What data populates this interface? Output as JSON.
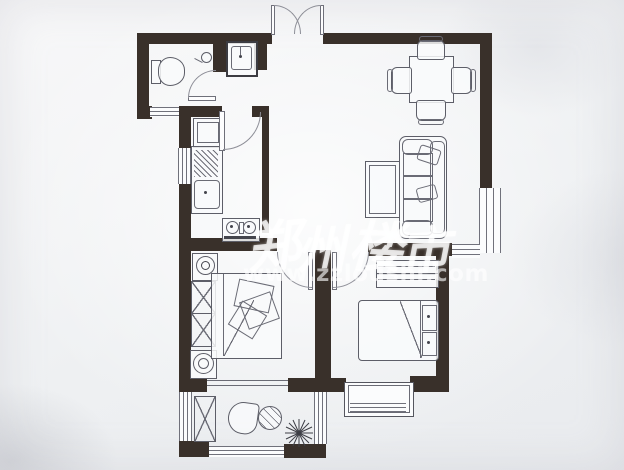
{
  "watermark": {
    "chars": [
      "郑",
      "州",
      "楼",
      "市"
    ],
    "url": "www.zzloushi.com"
  },
  "colors": {
    "wall": "#39302a",
    "furniture_line": "#5d5e68",
    "paper": "#f1f2f4",
    "watermark_text": "#ffffff"
  },
  "icons": {
    "plant": "sunburst-spokes",
    "shower_head": "circle-with-stem",
    "stove_burner": "ring-with-dot",
    "washing_machine": "square-with-drum-circle"
  }
}
